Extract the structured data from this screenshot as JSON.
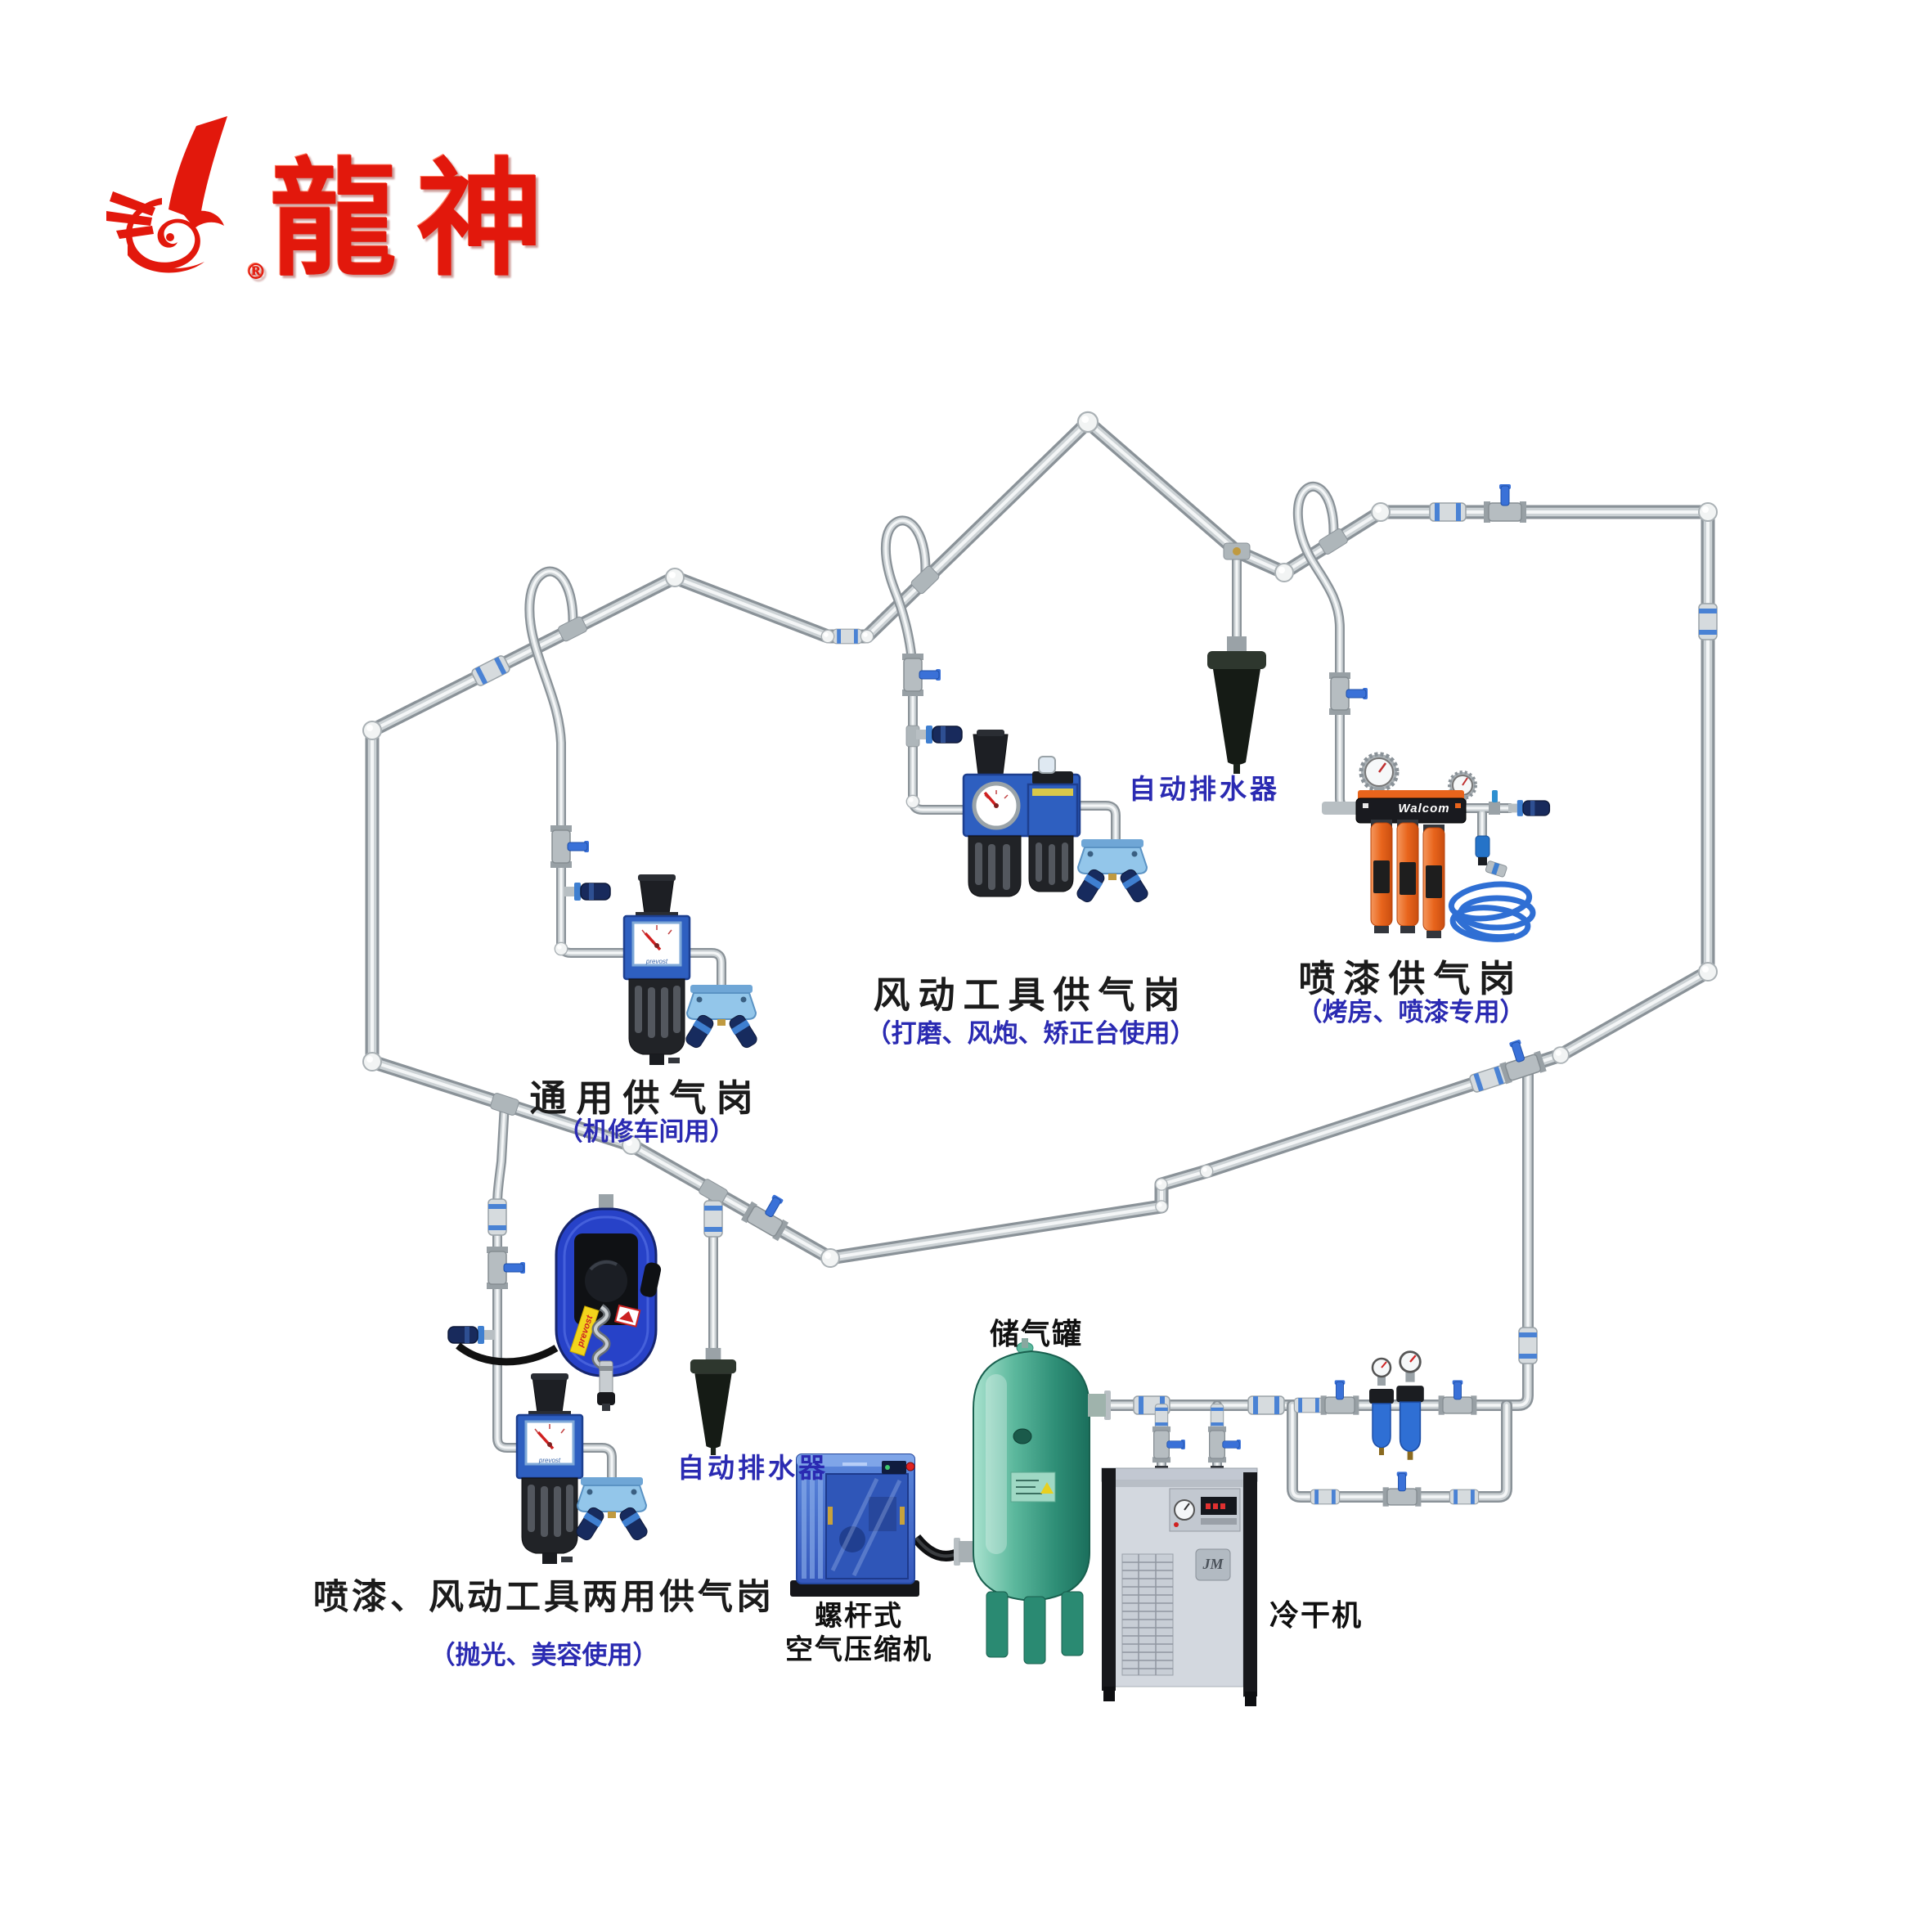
{
  "brand": {
    "logo_text": "龍神",
    "registered": "®",
    "logo_color": "#e2180c"
  },
  "stations": {
    "general": {
      "title": "通用供气岗",
      "subtitle": "（机修车间用）"
    },
    "pneumatic": {
      "title": "风动工具供气岗",
      "subtitle": "（打磨、风炮、矫正台使用）"
    },
    "paint": {
      "title": "喷漆供气岗",
      "subtitle": "（烤房、喷漆专用）"
    },
    "dual": {
      "title": "喷漆、风动工具两用供气岗",
      "subtitle": "（抛光、美容使用）"
    }
  },
  "equipment": {
    "auto_drain_top": "自动排水器",
    "auto_drain_bottom": "自动排水器",
    "tank": "储气罐",
    "compressor_line1": "螺杆式",
    "compressor_line2": "空气压缩机",
    "dryer": "冷干机",
    "filter_brand": "Walcom",
    "reel_brand": "prevost",
    "gauge_brand": "prevost",
    "dryer_badge": "JM"
  },
  "colors": {
    "title_black": "#1b1b1b",
    "label_blue": "#2a2ab2",
    "logo_red": "#e2180c",
    "pipe_gray": "#ccd2d5",
    "tank_teal": "#3f9e85",
    "equipment_blue": "#2e5fc0",
    "cartridge_orange": "#e8641c",
    "hose_blue": "#2f6fd4"
  }
}
